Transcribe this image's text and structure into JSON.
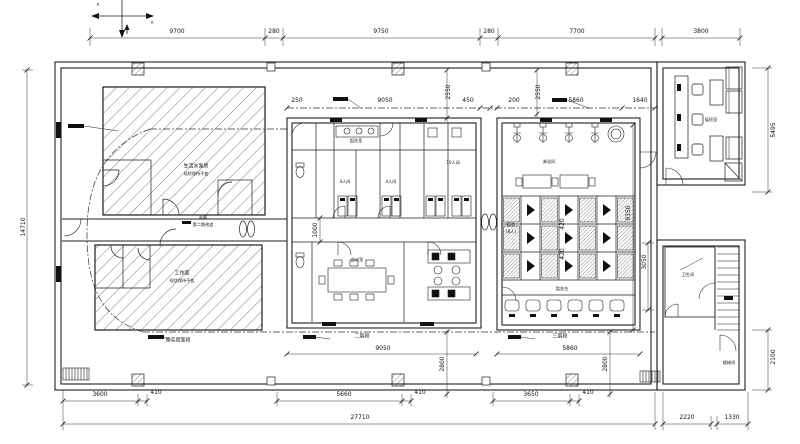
{
  "drawing": {
    "type": "architectural-floor-plan",
    "line_color": "#1f1f1f",
    "background": "#ffffff"
  },
  "section_marks": {
    "a": "A",
    "b": "A"
  },
  "dims": {
    "top": [
      "9700",
      "280",
      "9750",
      "280",
      "7700",
      "3800"
    ],
    "inner_top": [
      "250",
      "9050",
      "450",
      "200",
      "5860",
      "1640"
    ],
    "inner_top_vertical": [
      "2550",
      "2550"
    ],
    "left_vertical": "14710",
    "right_vertical": [
      "5495",
      "9350",
      "3050",
      "2100"
    ],
    "middle_vertical": [
      "1000",
      "420",
      "420"
    ],
    "bottom_inner": [
      "9050",
      "5860"
    ],
    "bottom_inner_vertical": [
      "2800",
      "2800"
    ],
    "bottom_row1": [
      "3600",
      "410",
      "5660",
      "410",
      "3650",
      "410"
    ],
    "bottom_row2": [
      "27710",
      "2220",
      "1330"
    ]
  },
  "rooms": {
    "pump_room": {
      "name": "生活水泵房",
      "note": "现状保持不变"
    },
    "studio": {
      "name": "工作室",
      "note": "现状保持不变"
    },
    "corridor": {
      "name": "走廊",
      "note": "第二期改造"
    },
    "old_lab": "原实验室段",
    "section2": "二层段",
    "section3": "三层段",
    "washroom": "盥洗室",
    "room_4a": "4人间",
    "room_4b": "4人间",
    "room_10": "10人间",
    "meeting": "会议室",
    "shower": "淋浴间",
    "dorm_name": "宿舍",
    "dorm_cap": "(8人)",
    "wash_counter": "盥洗台",
    "duty": "值班室",
    "toilet": "卫生间",
    "stairwell": "楼梯间"
  }
}
